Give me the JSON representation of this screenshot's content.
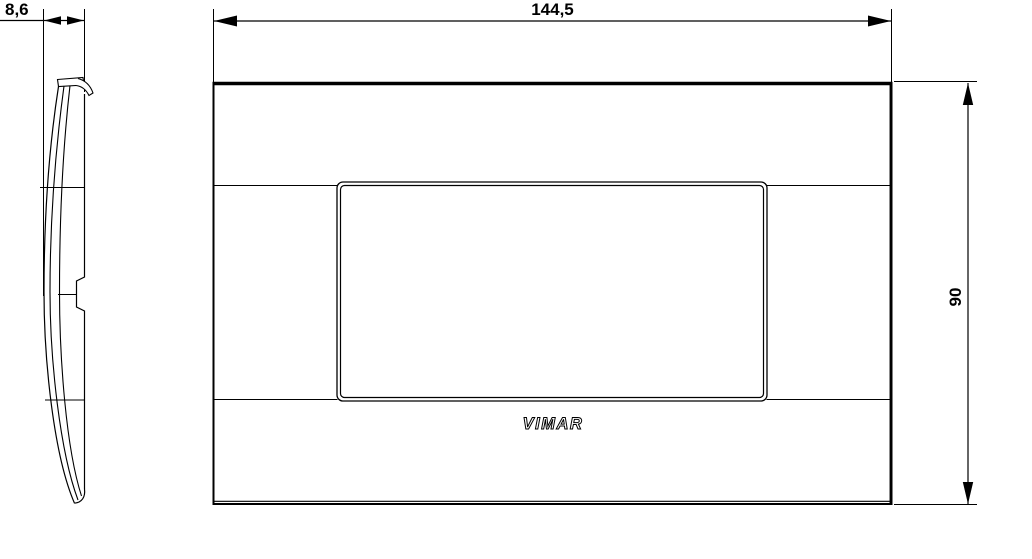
{
  "page": {
    "background": "#ffffff",
    "line_color": "#000000",
    "type": "technical-drawing"
  },
  "dimensions": {
    "depth": "8,6",
    "width": "144,5",
    "height": "90"
  },
  "logo": "VIMAR"
}
